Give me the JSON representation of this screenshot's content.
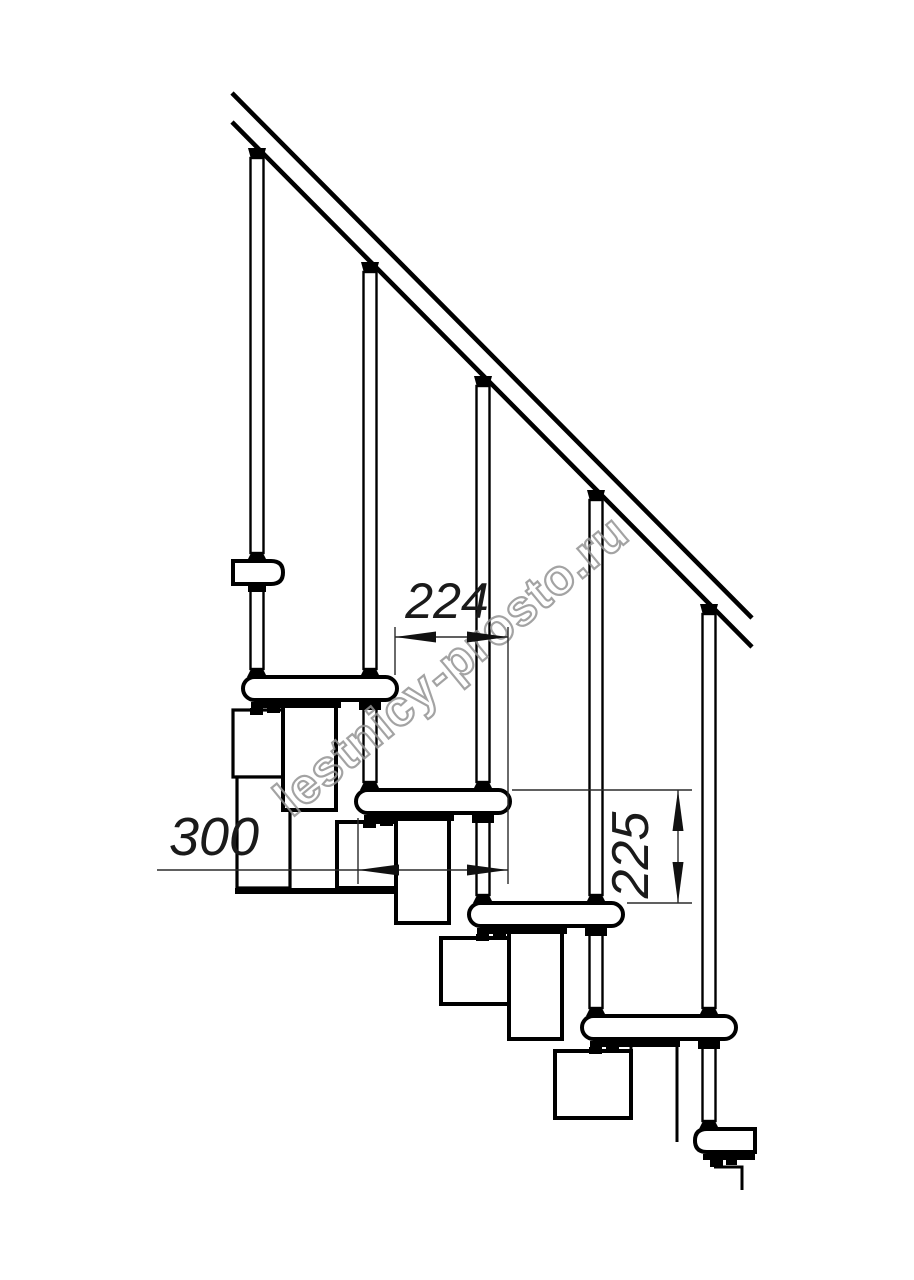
{
  "watermark": {
    "text": "lestnicy-prosto.ru",
    "color": "#949494"
  },
  "dimensions": {
    "run": "224",
    "depth": "300",
    "rise": "225"
  },
  "colors": {
    "line": "#000000",
    "dimension": "#2b2b2b",
    "background": "#ffffff"
  }
}
